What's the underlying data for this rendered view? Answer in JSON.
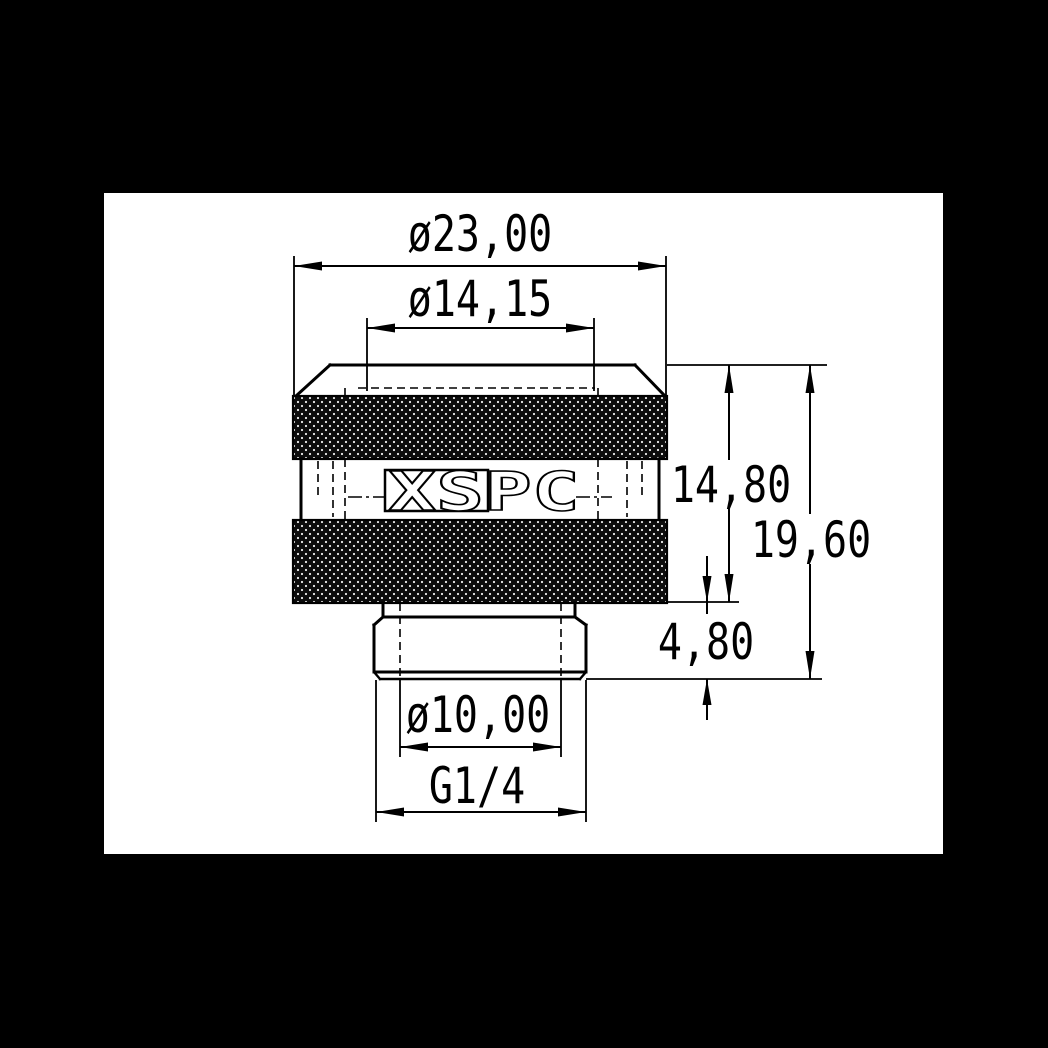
{
  "page": {
    "background_color": "#000000",
    "paper_color": "#ffffff",
    "ink_color": "#000000",
    "kind": "technical dimension drawing"
  },
  "drawing": {
    "logo_text": "XSPC",
    "dimensions": {
      "knurl_outer_diameter": "ø23,00",
      "top_opening_diameter": "ø14,15",
      "upper_body_height": "14,80",
      "overall_height": "19,60",
      "thread_section_height": "4,80",
      "bore_diameter": "ø10,00",
      "thread_size": "G1/4"
    }
  }
}
